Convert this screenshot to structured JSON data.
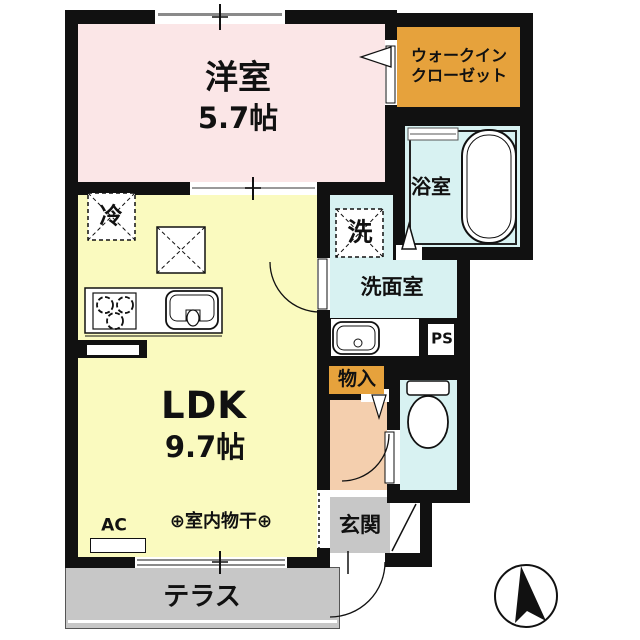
{
  "plan": {
    "rooms": {
      "western": {
        "label": "洋室",
        "size": "5.7帖"
      },
      "wic": {
        "line1": "ウォークイン",
        "line2": "クローゼット"
      },
      "bath": {
        "label": "浴室"
      },
      "washer": {
        "label": "洗"
      },
      "washroom": {
        "label": "洗面室"
      },
      "ps": {
        "label": "PS"
      },
      "storage": {
        "label": "物入"
      },
      "ldk": {
        "label": "LDK",
        "size": "9.7帖"
      },
      "fridge": {
        "label": "冷"
      },
      "ac": {
        "label": "AC"
      },
      "drying": {
        "label": "⊕室内物干⊕"
      },
      "entrance": {
        "label": "玄関"
      },
      "terrace": {
        "label": "テラス"
      }
    },
    "colors": {
      "western": "#fbe6e7",
      "wic": "#e6a23c",
      "water": "#d8f2f2",
      "ldk": "#fafabf",
      "hall": "#f4cfae",
      "gray": "#c7c7c7",
      "storage": "#e6a23c",
      "wall": "#111111"
    }
  }
}
